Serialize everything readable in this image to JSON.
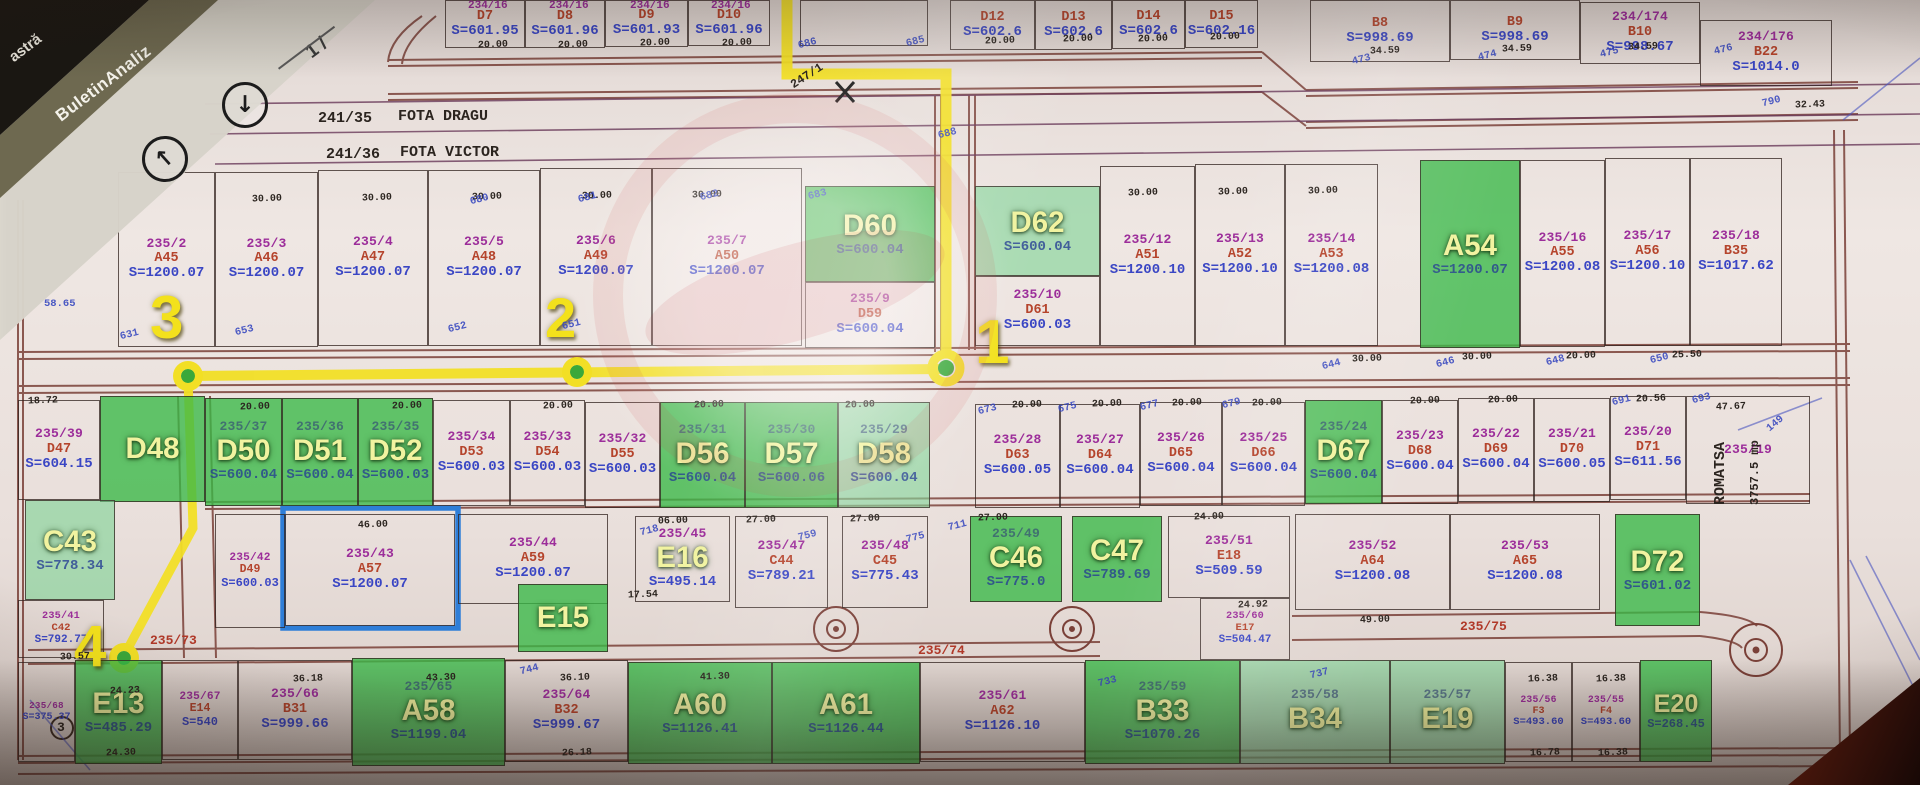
{
  "scanner": {
    "tab_back": "astră",
    "tab_title": "BuletinAnaliz",
    "page_indicator": "1 /",
    "down_icon": "↓",
    "up_icon": "↑"
  },
  "owner_strips": [
    {
      "id": "241/35",
      "owner": "FOTA DRAGU"
    },
    {
      "id": "241/36",
      "owner": "FOTA VICTOR"
    }
  ],
  "right_parcel": {
    "number": "235/19",
    "name": "ROMATSA",
    "area": "3757.5 mp"
  },
  "annotation": {
    "points": [
      "1",
      "2",
      "3",
      "4"
    ],
    "boxed_parcel": "235/43",
    "yellow": "#f2df25",
    "blue_box": "#2e7ed8"
  },
  "colors": {
    "green_full": "#38b846",
    "green_light": "#80d496",
    "number": "#9c2d9a",
    "code": "#b5442c",
    "area": "#3a46c4"
  },
  "parcels": [
    {
      "c": "D7",
      "a": "S=601.95",
      "x": 445,
      "y": 0,
      "w": 80,
      "h": 48
    },
    {
      "c": "D8",
      "a": "S=601.96",
      "x": 525,
      "y": 0,
      "w": 80,
      "h": 48
    },
    {
      "c": "D9",
      "a": "S=601.93",
      "x": 605,
      "y": 0,
      "w": 83,
      "h": 47
    },
    {
      "c": "D10",
      "a": "S=601.96",
      "x": 688,
      "y": 0,
      "w": 82,
      "h": 46
    },
    {
      "x": 800,
      "y": 0,
      "w": 128,
      "h": 46
    },
    {
      "c": "D12",
      "a": "S=602.6",
      "x": 950,
      "y": 0,
      "w": 85,
      "h": 50
    },
    {
      "c": "D13",
      "a": "S=602.6",
      "x": 1035,
      "y": 0,
      "w": 77,
      "h": 50
    },
    {
      "c": "D14",
      "a": "S=602.6",
      "x": 1112,
      "y": 0,
      "w": 73,
      "h": 49
    },
    {
      "c": "D15",
      "a": "S=602.16",
      "x": 1185,
      "y": 0,
      "w": 73,
      "h": 48
    },
    {
      "c": "B8",
      "a": "S=998.69",
      "x": 1310,
      "y": 0,
      "w": 140,
      "h": 62
    },
    {
      "c": "B9",
      "a": "S=998.69",
      "x": 1450,
      "y": 0,
      "w": 130,
      "h": 60
    },
    {
      "n": "234/174",
      "c": "B10",
      "a": "S=998.67",
      "x": 1580,
      "y": 2,
      "w": 120,
      "h": 62
    },
    {
      "n": "234/176",
      "c": "B22",
      "a": "S=1014.0",
      "x": 1700,
      "y": 20,
      "w": 132,
      "h": 66
    },
    {
      "n": "235/2",
      "c": "A45",
      "a": "S=1200.07",
      "x": 118,
      "y": 172,
      "w": 97,
      "h": 175
    },
    {
      "n": "235/3",
      "c": "A46",
      "a": "S=1200.07",
      "x": 215,
      "y": 172,
      "w": 103,
      "h": 175
    },
    {
      "n": "235/4",
      "c": "A47",
      "a": "S=1200.07",
      "x": 318,
      "y": 170,
      "w": 110,
      "h": 176
    },
    {
      "n": "235/5",
      "c": "A48",
      "a": "S=1200.07",
      "x": 428,
      "y": 170,
      "w": 112,
      "h": 176
    },
    {
      "n": "235/6",
      "c": "A49",
      "a": "S=1200.07",
      "x": 540,
      "y": 168,
      "w": 112,
      "h": 178
    },
    {
      "n": "235/7",
      "c": "A50",
      "a": "S=1200.07",
      "x": 652,
      "y": 168,
      "w": 150,
      "h": 178
    },
    {
      "c": "D60",
      "a": "S=600.04",
      "x": 805,
      "y": 186,
      "w": 130,
      "h": 96,
      "f": 1,
      "oc": 1
    },
    {
      "n": "235/9",
      "c": "D59",
      "a": "S=600.04",
      "x": 805,
      "y": 282,
      "w": 130,
      "h": 66
    },
    {
      "c": "D62",
      "a": "S=600.04",
      "x": 975,
      "y": 186,
      "w": 125,
      "h": 90,
      "f": 2,
      "oc": 1
    },
    {
      "n": "235/10",
      "c": "D61",
      "a": "S=600.03",
      "x": 975,
      "y": 276,
      "w": 125,
      "h": 70
    },
    {
      "n": "235/12",
      "c": "A51",
      "a": "S=1200.10",
      "x": 1100,
      "y": 166,
      "w": 95,
      "h": 180
    },
    {
      "n": "235/13",
      "c": "A52",
      "a": "S=1200.10",
      "x": 1195,
      "y": 164,
      "w": 90,
      "h": 182
    },
    {
      "n": "235/14",
      "c": "A53",
      "a": "S=1200.08",
      "x": 1285,
      "y": 164,
      "w": 93,
      "h": 182
    },
    {
      "c": "A54",
      "a": "S=1200.07",
      "x": 1420,
      "y": 160,
      "w": 100,
      "h": 188,
      "f": 1,
      "oc": 1
    },
    {
      "n": "235/16",
      "c": "A55",
      "a": "S=1200.08",
      "x": 1520,
      "y": 160,
      "w": 85,
      "h": 187
    },
    {
      "n": "235/17",
      "c": "A56",
      "a": "S=1200.10",
      "x": 1605,
      "y": 158,
      "w": 85,
      "h": 188
    },
    {
      "n": "235/18",
      "c": "B35",
      "a": "S=1017.62",
      "x": 1690,
      "y": 158,
      "w": 92,
      "h": 188
    },
    {
      "n": "235/39",
      "c": "D47",
      "a": "S=604.15",
      "x": 18,
      "y": 400,
      "w": 82,
      "h": 100
    },
    {
      "c": "D48",
      "x": 100,
      "y": 396,
      "w": 105,
      "h": 106,
      "f": 1,
      "oc": 1
    },
    {
      "n": "235/37",
      "c": "D50",
      "a": "S=600.04",
      "x": 205,
      "y": 398,
      "w": 77,
      "h": 108,
      "f": 1,
      "oc": 1
    },
    {
      "n": "235/36",
      "c": "D51",
      "a": "S=600.04",
      "x": 282,
      "y": 398,
      "w": 76,
      "h": 108,
      "f": 1,
      "oc": 1
    },
    {
      "n": "235/35",
      "c": "D52",
      "a": "S=600.03",
      "x": 358,
      "y": 398,
      "w": 75,
      "h": 108,
      "f": 1,
      "oc": 1
    },
    {
      "n": "235/34",
      "c": "D53",
      "a": "S=600.03",
      "x": 433,
      "y": 400,
      "w": 77,
      "h": 106
    },
    {
      "n": "235/33",
      "c": "D54",
      "a": "S=600.03",
      "x": 510,
      "y": 400,
      "w": 75,
      "h": 106
    },
    {
      "n": "235/32",
      "c": "D55",
      "a": "S=600.03",
      "x": 585,
      "y": 402,
      "w": 75,
      "h": 106
    },
    {
      "n": "235/31",
      "c": "D56",
      "a": "S=600.04",
      "x": 660,
      "y": 402,
      "w": 85,
      "h": 106,
      "f": 1,
      "oc": 1
    },
    {
      "n": "235/30",
      "c": "D57",
      "a": "S=600.06",
      "x": 745,
      "y": 402,
      "w": 93,
      "h": 106,
      "f": 1,
      "oc": 1
    },
    {
      "n": "235/29",
      "c": "D58",
      "a": "S=600.04",
      "x": 838,
      "y": 402,
      "w": 92,
      "h": 106,
      "f": 2,
      "oc": 1
    },
    {
      "n": "235/28",
      "c": "D63",
      "a": "S=600.05",
      "x": 975,
      "y": 404,
      "w": 85,
      "h": 104
    },
    {
      "n": "235/27",
      "c": "D64",
      "a": "S=600.04",
      "x": 1060,
      "y": 404,
      "w": 80,
      "h": 104
    },
    {
      "n": "235/26",
      "c": "D65",
      "a": "S=600.04",
      "x": 1140,
      "y": 402,
      "w": 82,
      "h": 104
    },
    {
      "n": "235/25",
      "c": "D66",
      "a": "S=600.04",
      "x": 1222,
      "y": 402,
      "w": 83,
      "h": 104
    },
    {
      "n": "235/24",
      "c": "D67",
      "a": "S=600.04",
      "x": 1305,
      "y": 400,
      "w": 77,
      "h": 104,
      "f": 1,
      "oc": 1
    },
    {
      "n": "235/23",
      "c": "D68",
      "a": "S=600.04",
      "x": 1382,
      "y": 400,
      "w": 76,
      "h": 104
    },
    {
      "n": "235/22",
      "c": "D69",
      "a": "S=600.04",
      "x": 1458,
      "y": 398,
      "w": 76,
      "h": 104
    },
    {
      "n": "235/21",
      "c": "D70",
      "a": "S=600.05",
      "x": 1534,
      "y": 398,
      "w": 76,
      "h": 104
    },
    {
      "n": "235/20",
      "c": "D71",
      "a": "S=611.56",
      "x": 1610,
      "y": 396,
      "w": 76,
      "h": 104
    },
    {
      "n": "235/19",
      "x": 1686,
      "y": 396,
      "w": 124,
      "h": 108
    },
    {
      "c": "C43",
      "a": "S=778.34",
      "x": 25,
      "y": 500,
      "w": 90,
      "h": 100,
      "f": 2,
      "oc": 1
    },
    {
      "n": "235/41",
      "c": "C42",
      "a": "S=792.77",
      "x": 18,
      "y": 600,
      "w": 86,
      "h": 58,
      "fz": 11
    },
    {
      "n": "235/42",
      "c": "D49",
      "a": "S=600.03",
      "x": 215,
      "y": 514,
      "w": 70,
      "h": 114,
      "fz": 12
    },
    {
      "n": "235/43",
      "c": "A57",
      "a": "S=1200.07",
      "x": 285,
      "y": 514,
      "w": 170,
      "h": 112
    },
    {
      "n": "235/44",
      "c": "A59",
      "a": "S=1200.07",
      "x": 458,
      "y": 514,
      "w": 150,
      "h": 90
    },
    {
      "c": "E15",
      "x": 518,
      "y": 584,
      "w": 90,
      "h": 68,
      "f": 1,
      "oc": 1
    },
    {
      "n": "235/45",
      "c": "E16",
      "a": "S=495.14",
      "x": 635,
      "y": 516,
      "w": 95,
      "h": 86,
      "oc": 1
    },
    {
      "n": "235/47",
      "c": "C44",
      "a": "S=789.21",
      "x": 735,
      "y": 516,
      "w": 93,
      "h": 92
    },
    {
      "n": "235/48",
      "c": "C45",
      "a": "S=775.43",
      "x": 842,
      "y": 516,
      "w": 86,
      "h": 92
    },
    {
      "n": "235/49",
      "c": "C46",
      "a": "S=775.0",
      "x": 970,
      "y": 516,
      "w": 92,
      "h": 86,
      "f": 1,
      "oc": 1
    },
    {
      "c": "C47",
      "a": "S=789.69",
      "x": 1072,
      "y": 516,
      "w": 90,
      "h": 86,
      "f": 1,
      "oc": 1
    },
    {
      "n": "235/51",
      "c": "E18",
      "a": "S=509.59",
      "x": 1168,
      "y": 516,
      "w": 122,
      "h": 82
    },
    {
      "n": "235/60",
      "c": "E17",
      "a": "S=504.47",
      "x": 1200,
      "y": 598,
      "w": 90,
      "h": 62,
      "fz": 11
    },
    {
      "n": "235/52",
      "c": "A64",
      "a": "S=1200.08",
      "x": 1295,
      "y": 514,
      "w": 155,
      "h": 96
    },
    {
      "n": "235/53",
      "c": "A65",
      "a": "S=1200.08",
      "x": 1450,
      "y": 514,
      "w": 150,
      "h": 96
    },
    {
      "c": "D72",
      "a": "S=601.02",
      "x": 1615,
      "y": 514,
      "w": 85,
      "h": 112,
      "f": 1,
      "oc": 1
    },
    {
      "n": "235/68",
      "a": "S=375.37",
      "x": 18,
      "y": 662,
      "w": 57,
      "h": 100,
      "fz": 10
    },
    {
      "c": "E13",
      "a": "S=485.29",
      "x": 75,
      "y": 660,
      "w": 87,
      "h": 104,
      "f": 1,
      "oc": 1
    },
    {
      "n": "235/67",
      "c": "E14",
      "a": "S=540",
      "x": 162,
      "y": 660,
      "w": 76,
      "h": 100,
      "fz": 12
    },
    {
      "n": "235/66",
      "c": "B31",
      "a": "S=999.66",
      "x": 238,
      "y": 660,
      "w": 114,
      "h": 100
    },
    {
      "n": "235/65",
      "c": "A58",
      "a": "S=1199.04",
      "x": 352,
      "y": 658,
      "w": 153,
      "h": 108,
      "f": 1,
      "oc": 1
    },
    {
      "n": "235/64",
      "c": "B32",
      "a": "S=999.67",
      "x": 505,
      "y": 660,
      "w": 123,
      "h": 102
    },
    {
      "c": "A60",
      "a": "S=1126.41",
      "x": 628,
      "y": 662,
      "w": 144,
      "h": 102,
      "f": 1,
      "oc": 1
    },
    {
      "c": "A61",
      "a": "S=1126.44",
      "x": 772,
      "y": 662,
      "w": 148,
      "h": 102,
      "f": 1,
      "oc": 1
    },
    {
      "n": "235/61",
      "c": "A62",
      "a": "S=1126.10",
      "x": 920,
      "y": 662,
      "w": 165,
      "h": 100
    },
    {
      "n": "235/59",
      "c": "B33",
      "a": "S=1070.26",
      "x": 1085,
      "y": 660,
      "w": 155,
      "h": 104,
      "f": 1,
      "oc": 1
    },
    {
      "n": "235/58",
      "c": "B34",
      "x": 1240,
      "y": 660,
      "w": 150,
      "h": 104,
      "f": 2,
      "oc": 1
    },
    {
      "n": "235/57",
      "c": "E19",
      "x": 1390,
      "y": 660,
      "w": 115,
      "h": 104,
      "f": 2,
      "oc": 1
    },
    {
      "n": "235/56",
      "c": "F3",
      "a": "S=493.60",
      "x": 1505,
      "y": 662,
      "w": 67,
      "h": 100,
      "fz": 10.5
    },
    {
      "n": "235/55",
      "c": "F4",
      "a": "S=493.60",
      "x": 1572,
      "y": 662,
      "w": 68,
      "h": 100,
      "fz": 10.5
    },
    {
      "c": "E20",
      "a": "S=268.45",
      "x": 1640,
      "y": 660,
      "w": 72,
      "h": 102,
      "f": 1,
      "oc": 1,
      "fz": 12
    }
  ],
  "labels": [
    {
      "t": "241/35",
      "x": 318,
      "y": 110,
      "c": "blk",
      "s": 15
    },
    {
      "t": "FOTA DRAGU",
      "x": 398,
      "y": 108,
      "c": "blk",
      "s": 15
    },
    {
      "t": "241/36",
      "x": 326,
      "y": 146,
      "c": "blk",
      "s": 15
    },
    {
      "t": "FOTA VICTOR",
      "x": 400,
      "y": 144,
      "c": "blk",
      "s": 15
    },
    {
      "t": "235/73",
      "x": 150,
      "y": 633,
      "c": "red",
      "s": 13
    },
    {
      "t": "235/74",
      "x": 918,
      "y": 643,
      "c": "red",
      "s": 13
    },
    {
      "t": "235/75",
      "x": 1460,
      "y": 619,
      "c": "red",
      "s": 13
    },
    {
      "t": "247/1",
      "x": 788,
      "y": 80,
      "c": "blk",
      "s": 12,
      "r": -33
    },
    {
      "t": "ROMATSA",
      "x": 1712,
      "y": 505,
      "c": "blk",
      "s": 15,
      "r": -90
    },
    {
      "t": "3757.5 mp",
      "x": 1748,
      "y": 505,
      "c": "blk",
      "s": 12,
      "r": -90
    },
    {
      "t": "234/16",
      "x": 468,
      "y": 0,
      "c": "mag",
      "s": 11
    },
    {
      "t": "234/16",
      "x": 549,
      "y": 0,
      "c": "mag",
      "s": 11
    },
    {
      "t": "234/16",
      "x": 630,
      "y": 0,
      "c": "mag",
      "s": 11
    },
    {
      "t": "234/16",
      "x": 711,
      "y": 0,
      "c": "mag",
      "s": 11
    },
    {
      "t": "1",
      "x": 975,
      "y": 312,
      "c": "ylab",
      "s": 62
    },
    {
      "t": "2",
      "x": 545,
      "y": 290,
      "c": "ylab",
      "s": 56
    },
    {
      "t": "3",
      "x": 150,
      "y": 288,
      "c": "ylab",
      "s": 60
    },
    {
      "t": "4",
      "x": 74,
      "y": 618,
      "c": "ylab",
      "s": 58
    },
    {
      "t": "3",
      "x": 57,
      "y": 720,
      "c": "blk",
      "s": 13
    }
  ],
  "dims": [
    [
      "20.00",
      478,
      40
    ],
    [
      "20.00",
      558,
      40
    ],
    [
      "20.00",
      640,
      38
    ],
    [
      "20.00",
      722,
      38
    ],
    [
      "20.00",
      985,
      36
    ],
    [
      "20.00",
      1063,
      34
    ],
    [
      "20.00",
      1138,
      34
    ],
    [
      "20.00",
      1210,
      32
    ],
    [
      "34.59",
      1370,
      46
    ],
    [
      "34.59",
      1502,
      44
    ],
    [
      "34.59",
      1628,
      42
    ],
    [
      "32.43",
      1795,
      100
    ],
    [
      "30.00",
      252,
      194
    ],
    [
      "30.00",
      362,
      193
    ],
    [
      "30.00",
      472,
      192
    ],
    [
      "30.00",
      582,
      191
    ],
    [
      "30.00",
      692,
      190
    ],
    [
      "30.00",
      1128,
      188
    ],
    [
      "30.00",
      1218,
      187
    ],
    [
      "30.00",
      1308,
      186
    ],
    [
      "30.00",
      1352,
      354
    ],
    [
      "30.00",
      1462,
      352
    ],
    [
      "20.00",
      1566,
      351
    ],
    [
      "25.50",
      1672,
      350
    ],
    [
      "47.67",
      1716,
      402
    ],
    [
      "20.00",
      240,
      402
    ],
    [
      "20.00",
      392,
      401
    ],
    [
      "20.00",
      543,
      401
    ],
    [
      "20.00",
      694,
      400
    ],
    [
      "20.00",
      845,
      400
    ],
    [
      "20.00",
      1012,
      400
    ],
    [
      "20.00",
      1092,
      399
    ],
    [
      "20.00",
      1172,
      398
    ],
    [
      "20.00",
      1252,
      398
    ],
    [
      "20.00",
      1410,
      396
    ],
    [
      "20.00",
      1488,
      395
    ],
    [
      "20.56",
      1636,
      394
    ],
    [
      "06.00",
      658,
      516
    ],
    [
      "27.00",
      746,
      515
    ],
    [
      "27.00",
      850,
      514
    ],
    [
      "27.00",
      978,
      513
    ],
    [
      "24.00",
      1194,
      512
    ],
    [
      "17.54",
      628,
      590
    ],
    [
      "46.00",
      358,
      520
    ],
    [
      "49.00",
      1360,
      615
    ],
    [
      "24.92",
      1238,
      600
    ],
    [
      "24.23",
      110,
      686
    ],
    [
      "36.18",
      293,
      674
    ],
    [
      "43.30",
      426,
      673
    ],
    [
      "36.10",
      560,
      673
    ],
    [
      "41.30",
      700,
      672
    ],
    [
      "16.38",
      1528,
      674
    ],
    [
      "16.38",
      1596,
      674
    ],
    [
      "24.30",
      106,
      748
    ],
    [
      "26.18",
      562,
      748
    ],
    [
      "16.78",
      1530,
      748
    ],
    [
      "16.38",
      1598,
      748
    ],
    [
      "30.57",
      60,
      652
    ],
    [
      "18.72",
      28,
      396
    ]
  ],
  "points": [
    [
      "58.65",
      44,
      298,
      0
    ],
    [
      "686",
      798,
      38
    ],
    [
      "685",
      906,
      36
    ],
    [
      "473",
      1352,
      54
    ],
    [
      "474",
      1478,
      50
    ],
    [
      "475",
      1600,
      47
    ],
    [
      "476",
      1714,
      44
    ],
    [
      "790",
      1762,
      96
    ],
    [
      "680",
      470,
      194
    ],
    [
      "681",
      578,
      192
    ],
    [
      "682",
      700,
      190
    ],
    [
      "683",
      808,
      189
    ],
    [
      "652",
      448,
      322
    ],
    [
      "653",
      235,
      325
    ],
    [
      "651",
      562,
      319
    ],
    [
      "631",
      120,
      329
    ],
    [
      "644",
      1322,
      359
    ],
    [
      "646",
      1436,
      357
    ],
    [
      "648",
      1546,
      355
    ],
    [
      "650",
      1650,
      353
    ],
    [
      "688",
      938,
      128
    ],
    [
      "673",
      978,
      404
    ],
    [
      "675",
      1058,
      402
    ],
    [
      "677",
      1140,
      400
    ],
    [
      "679",
      1222,
      398
    ],
    [
      "691",
      1612,
      395
    ],
    [
      "693",
      1692,
      393
    ],
    [
      "711",
      948,
      520
    ],
    [
      "718",
      640,
      525
    ],
    [
      "733",
      1098,
      676
    ],
    [
      "737",
      1310,
      668
    ],
    [
      "149",
      1766,
      418,
      -40
    ],
    [
      "744",
      520,
      664
    ],
    [
      "759",
      798,
      530
    ],
    [
      "775",
      906,
      532
    ]
  ]
}
